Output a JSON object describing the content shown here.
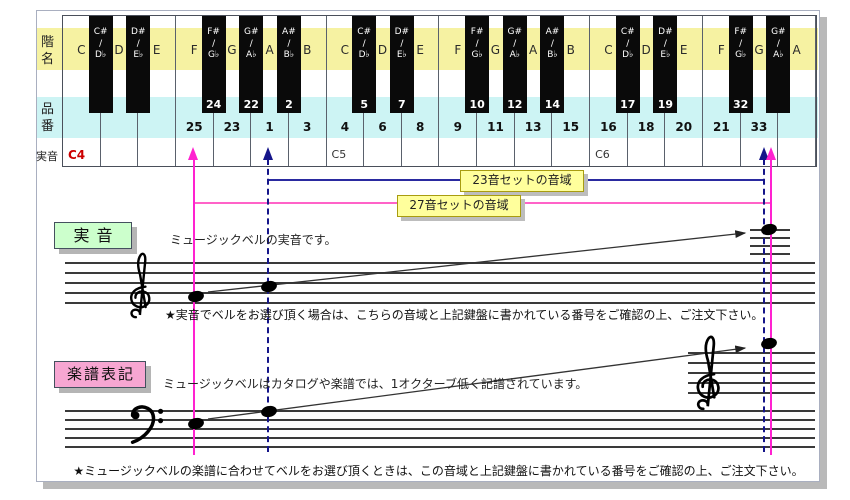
{
  "row_labels": {
    "pitch_names": "階名",
    "product_numbers": "品番",
    "actual_sound": "実音"
  },
  "keyboard": {
    "white_keys": [
      {
        "letter": "C",
        "number": "",
        "sound": "C4"
      },
      {
        "letter": "D",
        "number": ""
      },
      {
        "letter": "E",
        "number": ""
      },
      {
        "letter": "F",
        "number": "25"
      },
      {
        "letter": "G",
        "number": "23"
      },
      {
        "letter": "A",
        "number": "1"
      },
      {
        "letter": "B",
        "number": "3"
      },
      {
        "letter": "C",
        "number": "4",
        "sound": "C5"
      },
      {
        "letter": "D",
        "number": "6"
      },
      {
        "letter": "E",
        "number": "8"
      },
      {
        "letter": "F",
        "number": "9"
      },
      {
        "letter": "G",
        "number": "11"
      },
      {
        "letter": "A",
        "number": "13"
      },
      {
        "letter": "B",
        "number": "15"
      },
      {
        "letter": "C",
        "number": "16",
        "sound": "C6"
      },
      {
        "letter": "D",
        "number": "18"
      },
      {
        "letter": "E",
        "number": "20"
      },
      {
        "letter": "F",
        "number": "21"
      },
      {
        "letter": "G",
        "number": "33"
      },
      {
        "letter": "A",
        "number": ""
      }
    ],
    "black_keys": [
      {
        "sharp": "C#",
        "flat": "D♭",
        "number": "",
        "after": 0
      },
      {
        "sharp": "D#",
        "flat": "E♭",
        "number": "",
        "after": 1
      },
      {
        "sharp": "F#",
        "flat": "G♭",
        "number": "24",
        "after": 3
      },
      {
        "sharp": "G#",
        "flat": "A♭",
        "number": "22",
        "after": 4
      },
      {
        "sharp": "A#",
        "flat": "B♭",
        "number": "2",
        "after": 5
      },
      {
        "sharp": "C#",
        "flat": "D♭",
        "number": "5",
        "after": 7
      },
      {
        "sharp": "D#",
        "flat": "E♭",
        "number": "7",
        "after": 8
      },
      {
        "sharp": "F#",
        "flat": "G♭",
        "number": "10",
        "after": 10
      },
      {
        "sharp": "G#",
        "flat": "A♭",
        "number": "12",
        "after": 11
      },
      {
        "sharp": "A#",
        "flat": "B♭",
        "number": "14",
        "after": 12
      },
      {
        "sharp": "C#",
        "flat": "D♭",
        "number": "17",
        "after": 14
      },
      {
        "sharp": "D#",
        "flat": "E♭",
        "number": "19",
        "after": 15
      },
      {
        "sharp": "F#",
        "flat": "G♭",
        "number": "32",
        "after": 17
      },
      {
        "sharp": "G#",
        "flat": "A♭",
        "number": "",
        "after": 18
      }
    ]
  },
  "ranges": {
    "set23": {
      "label": "23音セットの音域"
    },
    "set27": {
      "label": "27音セットの音域"
    }
  },
  "sections": {
    "actual": {
      "label": "実音",
      "desc": "ミュージックベルの実音です。",
      "note": "★実音でベルをお選び頂く場合は、こちらの音域と上記鍵盤に書かれている番号をご確認の上、ご注文下さい。"
    },
    "notation": {
      "label": "楽譜表記",
      "desc": "ミュージックベルはカタログや楽譜では、1オクターブ低く記譜されています。",
      "note": "★ミュージックベルの楽譜に合わせてベルをお選び頂くときは、この音域と上記鍵盤に書かれている番号をご確認の上、ご注文下さい。"
    }
  },
  "colors": {
    "magenta_line": "#ff22d0",
    "pink_line": "#ff63c8",
    "navy_line": "#2a2aa0",
    "band_yellow": "#f6f2a2",
    "band_cyan": "#cdf4f4",
    "range_label_yellow": "#ffff9c",
    "actual_label_green": "#ccffcc",
    "notation_label_pink": "#f7a6d2",
    "c4_red": "#cc0000"
  }
}
